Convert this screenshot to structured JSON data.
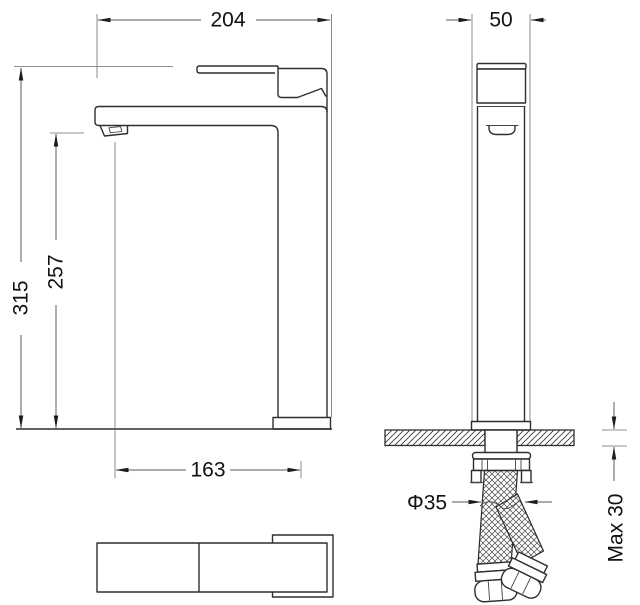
{
  "drawing": {
    "dimensions": {
      "spout_overall_width": "204",
      "body_depth": "50",
      "overall_height": "315",
      "outlet_height": "257",
      "spout_reach": "163",
      "hole_diameter": "Φ35",
      "max_deck_thickness": "Max 30"
    }
  }
}
